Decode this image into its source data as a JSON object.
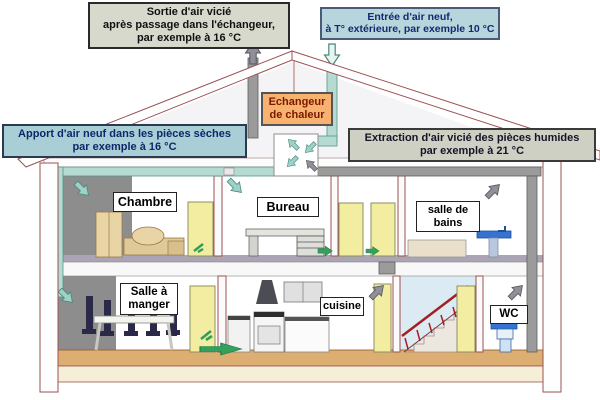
{
  "callouts": {
    "sortie_air": {
      "lines": [
        "Sortie d'air vicié",
        "après passage dans l'échangeur,",
        "par exemple à 16 °C"
      ]
    },
    "entree_air": {
      "lines": [
        "Entrée d'air neuf,",
        "à T° extérieure, par exemple 10 °C"
      ]
    },
    "apport_air": {
      "lines": [
        "Apport d'air neuf dans les pièces sèches",
        "par exemple à 16 °C"
      ]
    },
    "extraction_air": {
      "lines": [
        "Extraction d'air vicié des pièces humides",
        "par exemple à 21 °C"
      ]
    },
    "echangeur": {
      "lines": [
        "Echangeur",
        "de chaleur"
      ]
    }
  },
  "rooms": {
    "chambre": "Chambre",
    "bureau": "Bureau",
    "salle_de_bains": "salle de bains",
    "salle_a_manger": "Salle à manger",
    "cuisine": "cuisine",
    "wc": "WC"
  },
  "icons": {
    "fresh_air_in_arrow": "arrow-down-outline-teal",
    "stale_air_out_arrow": "arrow-up-solid-gray",
    "supply_arrows": "arrow-down-right-teal",
    "extraction_arrows": "arrow-up-right-gray",
    "transfer_arrows": "arrow-right-green"
  },
  "colors": {
    "fresh_air_duct": "#b5dad1",
    "stale_air_duct": "#9b9b9b",
    "transfer_arrow_green": "#33a05c",
    "exchanger_box_bg": "#f6b26e",
    "exchanger_text": "#7c1800",
    "cool_callout_bg": "#a9ced6",
    "warm_callout_bg": "#cdd0c2",
    "entry_callout_bg": "#b6d5dd",
    "callout_text_blue": "#10266a",
    "roof_outline": "#9c5252",
    "door_yellow": "#f3eda2",
    "floor_tan": "#dcae72",
    "fixture_blue": "#3573cf"
  }
}
